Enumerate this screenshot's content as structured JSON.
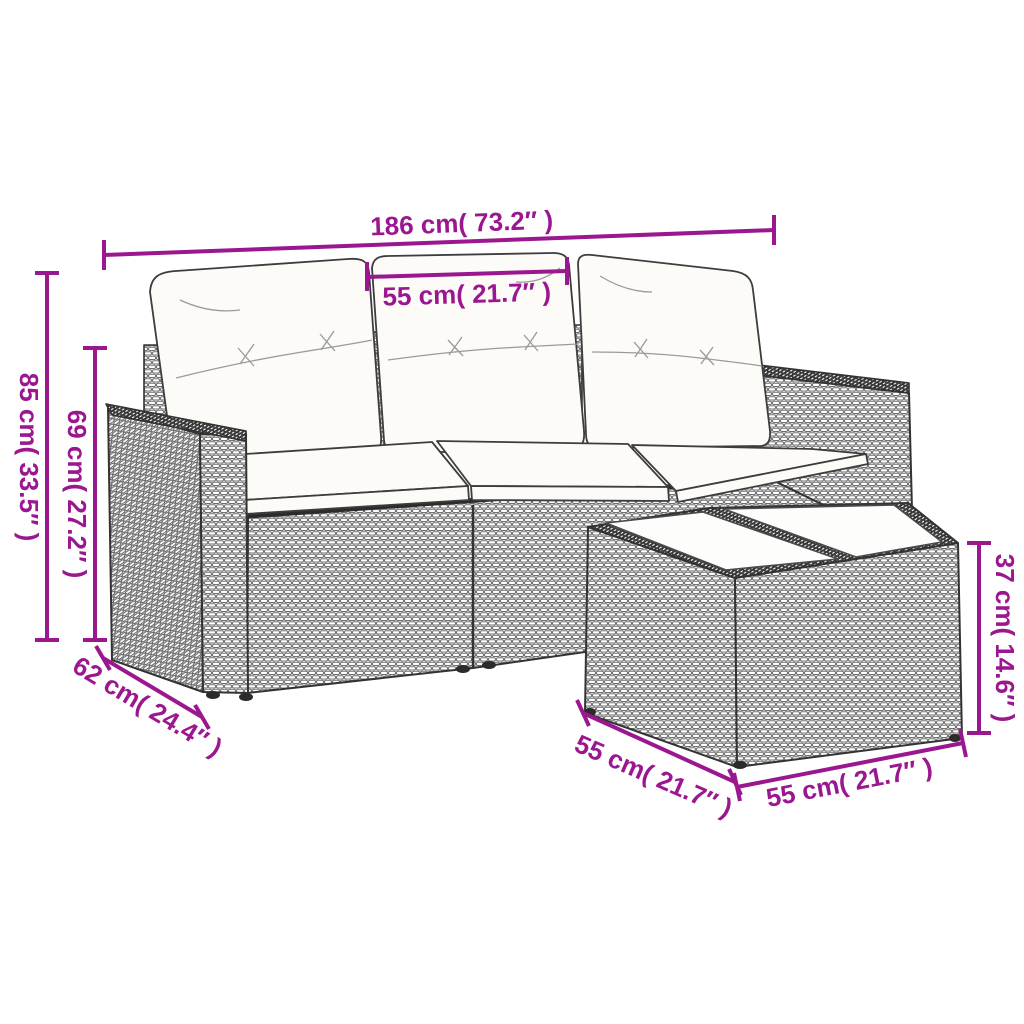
{
  "diagram": {
    "type": "product-dimension-diagram",
    "subject": "4-piece poly rattan garden lounge set: 3-seat modular sofa with white cushions and square glass-top coffee table",
    "accent_color": "#9b1790",
    "line_color": "#3a3a3a",
    "background": "#ffffff",
    "dimensions": {
      "sofa_width": {
        "label": "186 cm( 73.2″ )",
        "cm": 186,
        "inches": 73.2
      },
      "seat_width": {
        "label": "55 cm( 21.7″ )",
        "cm": 55,
        "inches": 21.7
      },
      "total_height": {
        "label": "85 cm( 33.5″ )",
        "cm": 85,
        "inches": 33.5
      },
      "frame_height": {
        "label": "69 cm( 27.2″ )",
        "cm": 69,
        "inches": 27.2
      },
      "sofa_depth": {
        "label": "62 cm( 24.4″ )",
        "cm": 62,
        "inches": 24.4
      },
      "table_depth": {
        "label": "55 cm( 21.7″ )",
        "cm": 55,
        "inches": 21.7
      },
      "table_width": {
        "label": "55 cm( 21.7″ )",
        "cm": 55,
        "inches": 21.7
      },
      "table_height": {
        "label": "37 cm( 14.6″ )",
        "cm": 37,
        "inches": 14.6
      }
    }
  }
}
